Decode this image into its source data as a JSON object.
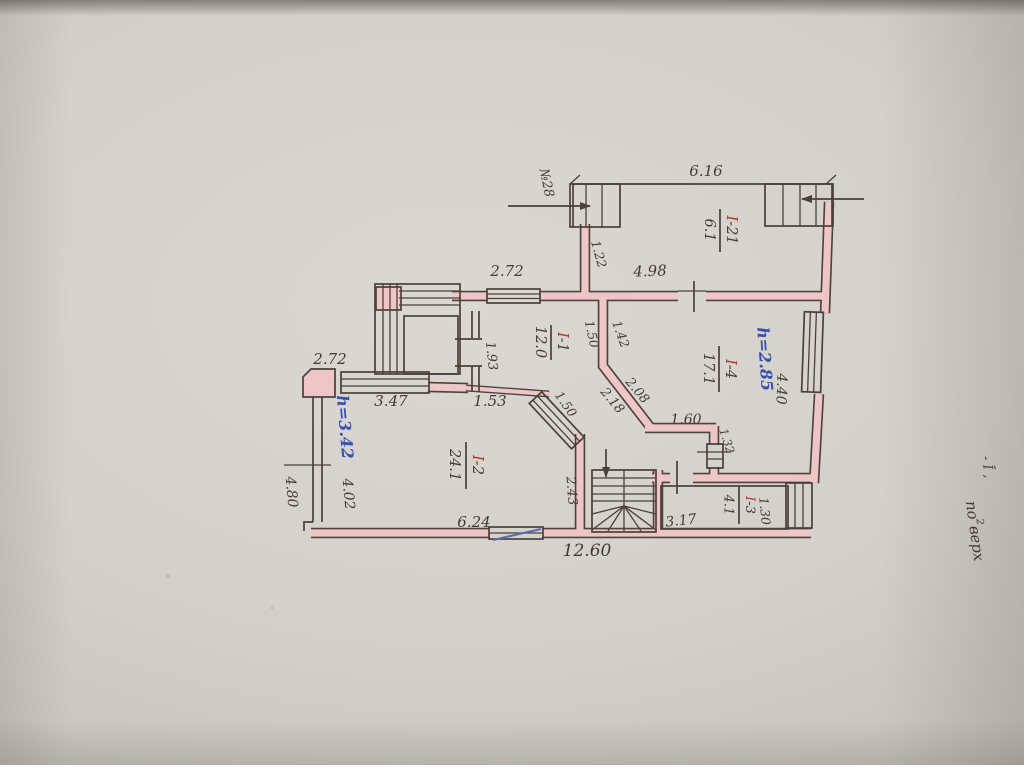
{
  "plan": {
    "house_number": "№28",
    "side_note": {
      "floor_mark": "- Ī ‚",
      "word_pre": "по",
      "word_sup": "2",
      "word_post": "верх"
    },
    "rooms": [
      {
        "prefix": "І",
        "suffix": "-21",
        "area": "6.1"
      },
      {
        "prefix": "І",
        "suffix": "-1",
        "area": "12.0"
      },
      {
        "prefix": "І",
        "suffix": "-4",
        "area": "17.1",
        "height": "h=2.85"
      },
      {
        "prefix": "І",
        "suffix": "-2",
        "area": "24.1",
        "height": "h=3.42"
      },
      {
        "prefix": "І",
        "suffix": "-3",
        "area": "4.1"
      }
    ],
    "dims": {
      "d616": "6.16",
      "d122": "1.22",
      "d498": "4.98",
      "d272_top": "2.72",
      "d193": "1.93",
      "d150_a": "1.50",
      "d142": "1.42",
      "d440": "4.40",
      "d208": "2.08",
      "d218": "2.18",
      "d150_b": "1.50",
      "d272_left": "2.72",
      "d347": "3.47",
      "d153": "1.53",
      "d480": "4.80",
      "d402": "4.02",
      "d243": "2.43",
      "d624": "6.24",
      "d1260": "12.60",
      "d317": "3.17",
      "d130": "1.30",
      "d160": "1.60",
      "d132": "1.32"
    },
    "colors": {
      "wall_fill": "#eec5c8",
      "ink": "#4a4138",
      "room_red": "#b6372e",
      "height_blue": "#3a50ad",
      "paper": "#cfcbc5"
    }
  }
}
